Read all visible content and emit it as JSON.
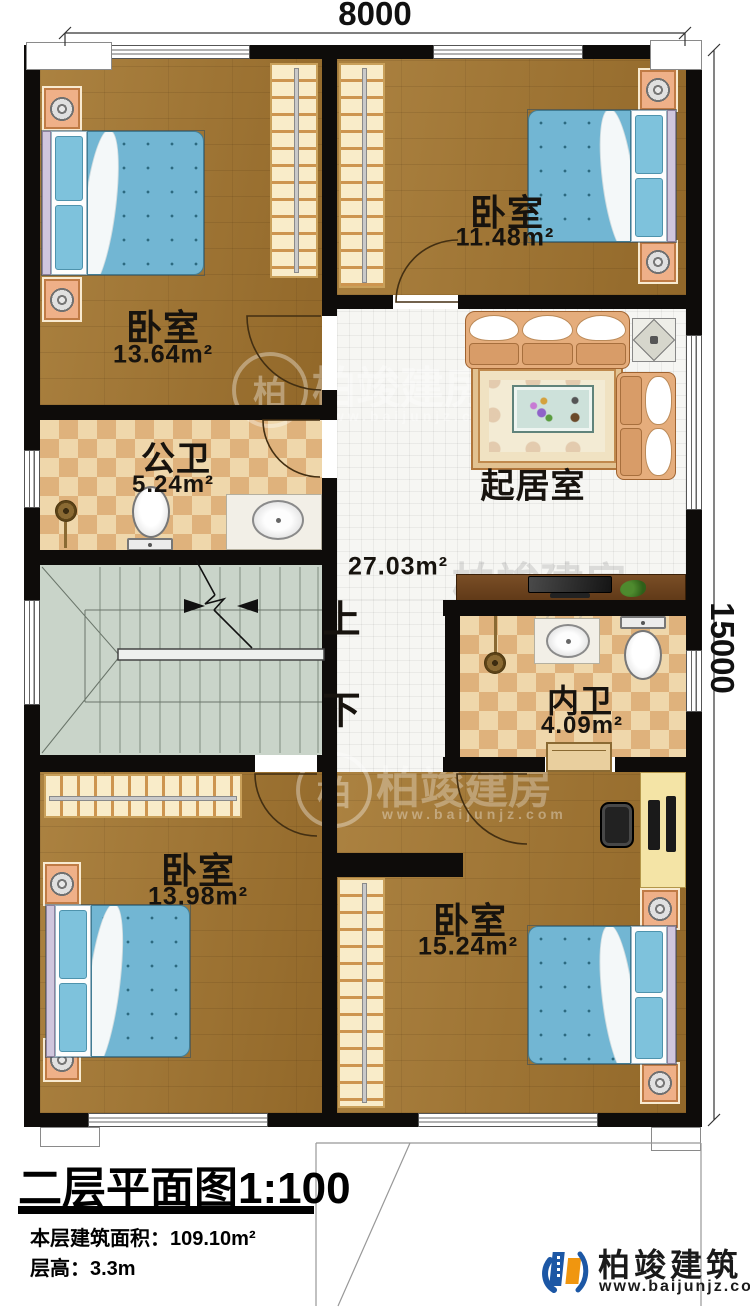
{
  "dimensions": {
    "width": "8000",
    "height": "15000"
  },
  "rooms": [
    {
      "name": "卧室",
      "area": "13.64m²"
    },
    {
      "name": "卧室",
      "area": "11.48m²"
    },
    {
      "name": "起居室",
      "area": "27.03m²"
    },
    {
      "name": "公卫",
      "area": "5.24m²"
    },
    {
      "name": "内卫",
      "area": "4.09m²"
    },
    {
      "name": "卧室",
      "area": "13.98m²"
    },
    {
      "name": "卧室",
      "area": "15.24m²"
    }
  ],
  "stairs": {
    "up": "上",
    "down": "下"
  },
  "title_block": {
    "title": "二层平面图",
    "scale": "1:100",
    "floor_area_label": "本层建筑面积：",
    "floor_area_value": "109.10m²",
    "floor_height_label": "层高：",
    "floor_height_value": "3.3m"
  },
  "logo": {
    "company": "柏竣建筑",
    "website": "www.baijunjz.com"
  },
  "watermark": {
    "brand": "柏竣建房",
    "website": "www.baijunjz.com",
    "initial": "柏"
  }
}
